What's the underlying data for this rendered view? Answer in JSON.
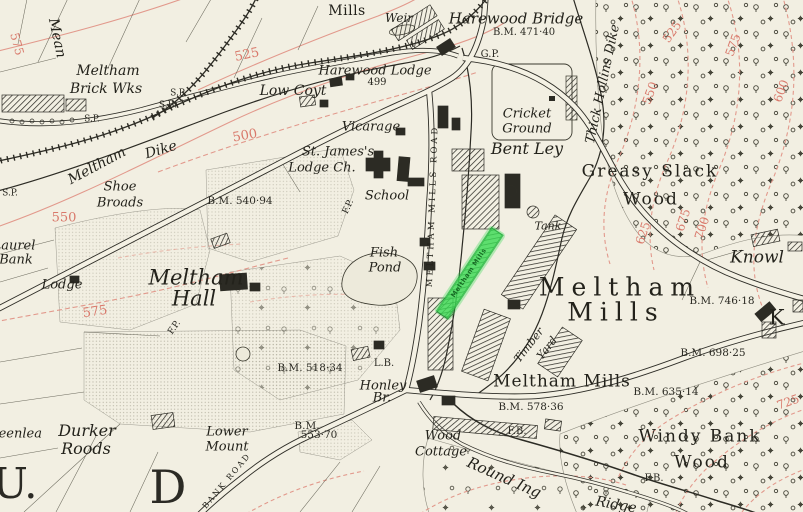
{
  "map": {
    "palette": {
      "paper": "#f2efe2",
      "ink": "#2c2b24",
      "contour_line": "#e2998c",
      "contour_label": "#d9796b",
      "highlight_green": "#3ddb55",
      "stipple_gray": "#a5a190"
    },
    "highlight": {
      "label": "Meltham Mills",
      "color": "#3ddb55"
    },
    "labels": [
      {
        "text": "Mills",
        "x": 347,
        "y": 11,
        "s": 14,
        "cls": "rm"
      },
      {
        "text": "Weir",
        "x": 399,
        "y": 18,
        "s": 12,
        "cls": "it"
      },
      {
        "text": "Harewood Bridge",
        "x": 516,
        "y": 19,
        "s": 15,
        "cls": "it"
      },
      {
        "text": "B.M. 471·40",
        "x": 524,
        "y": 33,
        "s": 10,
        "cls": "bm"
      },
      {
        "text": "G.P.",
        "x": 490,
        "y": 55,
        "s": 10,
        "cls": "bm"
      },
      {
        "text": "Harewood Lodge",
        "x": 375,
        "y": 71,
        "s": 13,
        "cls": "it"
      },
      {
        "text": "499",
        "x": 377,
        "y": 83,
        "s": 10,
        "cls": "bm"
      },
      {
        "text": "Mean",
        "x": 57,
        "y": 38,
        "s": 14,
        "rot": 78,
        "cls": "it"
      },
      {
        "text": "575",
        "x": 17,
        "y": 44,
        "s": 12,
        "rot": 75,
        "cls": "red"
      },
      {
        "text": "Meltham",
        "x": 108,
        "y": 71,
        "s": 14,
        "cls": "it"
      },
      {
        "text": "Brick Wks",
        "x": 106,
        "y": 89,
        "s": 14,
        "cls": "it"
      },
      {
        "text": "S.P.",
        "x": 178,
        "y": 94,
        "s": 9,
        "cls": "bm"
      },
      {
        "text": "S.B.",
        "x": 168,
        "y": 106,
        "s": 9,
        "cls": "bm"
      },
      {
        "text": "S.P.",
        "x": 92,
        "y": 120,
        "s": 9,
        "cls": "bm"
      },
      {
        "text": "S.P.",
        "x": 10,
        "y": 194,
        "s": 9,
        "cls": "bm"
      },
      {
        "text": "525",
        "x": 247,
        "y": 55,
        "s": 13,
        "rot": -12,
        "cls": "red"
      },
      {
        "text": "Low Coyt",
        "x": 293,
        "y": 91,
        "s": 14,
        "cls": "it"
      },
      {
        "text": "500",
        "x": 245,
        "y": 136,
        "s": 13,
        "rot": -10,
        "cls": "red"
      },
      {
        "text": "Vicarage",
        "x": 371,
        "y": 127,
        "s": 13,
        "cls": "it"
      },
      {
        "text": "St. James's",
        "x": 338,
        "y": 152,
        "s": 13,
        "cls": "it"
      },
      {
        "text": "Lodge Ch.",
        "x": 322,
        "y": 168,
        "s": 13,
        "cls": "it"
      },
      {
        "text": "Meltham",
        "x": 97,
        "y": 166,
        "s": 14,
        "rot": -28,
        "cls": "it"
      },
      {
        "text": "Dike",
        "x": 161,
        "y": 150,
        "s": 14,
        "rot": -16,
        "cls": "it"
      },
      {
        "text": "Shoe",
        "x": 120,
        "y": 187,
        "s": 13,
        "cls": "it"
      },
      {
        "text": "Broads",
        "x": 120,
        "y": 203,
        "s": 13,
        "cls": "it"
      },
      {
        "text": "550",
        "x": 64,
        "y": 218,
        "s": 13,
        "cls": "red"
      },
      {
        "text": "B.M. 540·94",
        "x": 240,
        "y": 201,
        "s": 10.5,
        "cls": "bm"
      },
      {
        "text": "School",
        "x": 387,
        "y": 196,
        "s": 13,
        "cls": "it"
      },
      {
        "text": "F.P.",
        "x": 349,
        "y": 207,
        "s": 9,
        "rot": -65,
        "cls": "bm"
      },
      {
        "text": "Laurel",
        "x": 14,
        "y": 246,
        "s": 13,
        "cls": "it"
      },
      {
        "text": "Bank",
        "x": 16,
        "y": 260,
        "s": 13,
        "cls": "it"
      },
      {
        "text": "Lodge",
        "x": 62,
        "y": 285,
        "s": 13,
        "cls": "it"
      },
      {
        "text": "Meltham",
        "x": 196,
        "y": 278,
        "s": 21,
        "cls": "it"
      },
      {
        "text": "Hall",
        "x": 194,
        "y": 299,
        "s": 21,
        "cls": "it"
      },
      {
        "text": "575",
        "x": 95,
        "y": 312,
        "s": 13,
        "rot": -8,
        "cls": "red"
      },
      {
        "text": "F.P.",
        "x": 175,
        "y": 328,
        "s": 9,
        "rot": -55,
        "cls": "bm"
      },
      {
        "text": "Fish",
        "x": 384,
        "y": 253,
        "s": 13,
        "cls": "it"
      },
      {
        "text": "Pond",
        "x": 385,
        "y": 268,
        "s": 13,
        "cls": "it"
      },
      {
        "text": "MELTHAM MILLS ROAD",
        "x": 433,
        "y": 206,
        "s": 8.5,
        "rot": -88,
        "cls": "caps",
        "ls": 3
      },
      {
        "text": "Cricket",
        "x": 527,
        "y": 114,
        "s": 13,
        "cls": "it"
      },
      {
        "text": "Ground",
        "x": 527,
        "y": 129,
        "s": 13,
        "cls": "it"
      },
      {
        "text": "Bent Ley",
        "x": 527,
        "y": 149,
        "s": 16,
        "cls": "it"
      },
      {
        "text": "Thick Hollins Dike",
        "x": 603,
        "y": 84,
        "s": 13,
        "rot": -78,
        "cls": "it"
      },
      {
        "text": "Greasy Slack",
        "x": 650,
        "y": 172,
        "s": 17,
        "cls": "wood"
      },
      {
        "text": "Wood",
        "x": 651,
        "y": 200,
        "s": 17,
        "cls": "wood"
      },
      {
        "text": "525",
        "x": 672,
        "y": 32,
        "s": 12,
        "rot": -55,
        "cls": "red"
      },
      {
        "text": "550",
        "x": 650,
        "y": 93,
        "s": 12,
        "rot": -70,
        "cls": "red"
      },
      {
        "text": "575",
        "x": 733,
        "y": 45,
        "s": 12,
        "rot": -70,
        "cls": "red"
      },
      {
        "text": "600",
        "x": 781,
        "y": 91,
        "s": 12,
        "rot": -70,
        "cls": "red"
      },
      {
        "text": "625",
        "x": 643,
        "y": 233,
        "s": 12,
        "rot": -72,
        "cls": "red"
      },
      {
        "text": "675",
        "x": 683,
        "y": 220,
        "s": 12,
        "rot": -72,
        "cls": "red"
      },
      {
        "text": "700",
        "x": 702,
        "y": 228,
        "s": 12,
        "rot": -72,
        "cls": "red"
      },
      {
        "text": "Tank",
        "x": 548,
        "y": 226,
        "s": 11,
        "cls": "it"
      },
      {
        "text": "Knowl",
        "x": 757,
        "y": 258,
        "s": 17,
        "cls": "it"
      },
      {
        "text": "B.M. 746·18",
        "x": 722,
        "y": 301,
        "s": 10.5,
        "cls": "bm"
      },
      {
        "text": "Meltham",
        "x": 620,
        "y": 287,
        "s": 25,
        "cls": "big2"
      },
      {
        "text": "Mills",
        "x": 616,
        "y": 312,
        "s": 25,
        "cls": "big2"
      },
      {
        "text": "K",
        "x": 777,
        "y": 318,
        "s": 21,
        "cls": "rm"
      },
      {
        "text": "B.M. 698·25",
        "x": 713,
        "y": 353,
        "s": 10.5,
        "cls": "bm"
      },
      {
        "text": "B.M. 635·14",
        "x": 666,
        "y": 392,
        "s": 10.5,
        "cls": "bm"
      },
      {
        "text": "Meltham Mills",
        "x": 562,
        "y": 382,
        "s": 17,
        "cls": "rm",
        "ls": 1
      },
      {
        "text": "B.M. 578·36",
        "x": 531,
        "y": 407,
        "s": 10.5,
        "cls": "bm"
      },
      {
        "text": "Timber",
        "x": 529,
        "y": 345,
        "s": 11,
        "rot": -52,
        "cls": "it"
      },
      {
        "text": "Yard",
        "x": 547,
        "y": 348,
        "s": 11,
        "rot": -52,
        "cls": "it"
      },
      {
        "text": "Windy Bank",
        "x": 700,
        "y": 437,
        "s": 17,
        "cls": "wood"
      },
      {
        "text": "Wood",
        "x": 702,
        "y": 463,
        "s": 17,
        "cls": "wood"
      },
      {
        "text": "F.B.",
        "x": 517,
        "y": 432,
        "s": 10,
        "cls": "bm"
      },
      {
        "text": "F.B.",
        "x": 654,
        "y": 479,
        "s": 10,
        "cls": "bm"
      },
      {
        "text": "Round Ing",
        "x": 504,
        "y": 478,
        "s": 15,
        "rot": 24,
        "cls": "it"
      },
      {
        "text": "Ridge",
        "x": 616,
        "y": 505,
        "s": 14,
        "rot": 10,
        "cls": "it"
      },
      {
        "text": "725",
        "x": 788,
        "y": 402,
        "s": 12,
        "rot": -20,
        "cls": "red"
      },
      {
        "text": "Wood",
        "x": 443,
        "y": 436,
        "s": 13,
        "cls": "it"
      },
      {
        "text": "Cottage",
        "x": 441,
        "y": 452,
        "s": 13,
        "cls": "it"
      },
      {
        "text": "Honley",
        "x": 383,
        "y": 386,
        "s": 13,
        "cls": "it"
      },
      {
        "text": "Br.",
        "x": 382,
        "y": 398,
        "s": 13,
        "cls": "it"
      },
      {
        "text": "L.B.",
        "x": 384,
        "y": 364,
        "s": 10,
        "cls": "bm"
      },
      {
        "text": "B.M. 518·34",
        "x": 310,
        "y": 368,
        "s": 10.5,
        "cls": "bm"
      },
      {
        "text": "Lower",
        "x": 227,
        "y": 432,
        "s": 13,
        "cls": "it"
      },
      {
        "text": "Mount",
        "x": 227,
        "y": 447,
        "s": 13,
        "cls": "it"
      },
      {
        "text": "B.M.",
        "x": 307,
        "y": 426,
        "s": 10.5,
        "cls": "bm"
      },
      {
        "text": "553·70",
        "x": 319,
        "y": 435,
        "s": 10.5,
        "cls": "bm"
      },
      {
        "text": "BANK ROAD",
        "x": 227,
        "y": 481,
        "s": 8,
        "rot": -50,
        "cls": "caps",
        "ls": 2
      },
      {
        "text": "Greenlea",
        "x": 12,
        "y": 434,
        "s": 13,
        "cls": "it"
      },
      {
        "text": "Durker",
        "x": 87,
        "y": 431,
        "s": 16,
        "cls": "it"
      },
      {
        "text": "Roods",
        "x": 86,
        "y": 449,
        "s": 16,
        "cls": "it"
      },
      {
        "text": "U.",
        "x": 15,
        "y": 484,
        "s": 42,
        "cls": "big"
      },
      {
        "text": "D",
        "x": 168,
        "y": 487,
        "s": 46,
        "cls": "big"
      },
      {
        "text": "Meltham Mills",
        "x": 469,
        "y": 273,
        "s": 6.5,
        "rot": -56,
        "cls": "hl",
        "ls": 0.5
      }
    ]
  }
}
